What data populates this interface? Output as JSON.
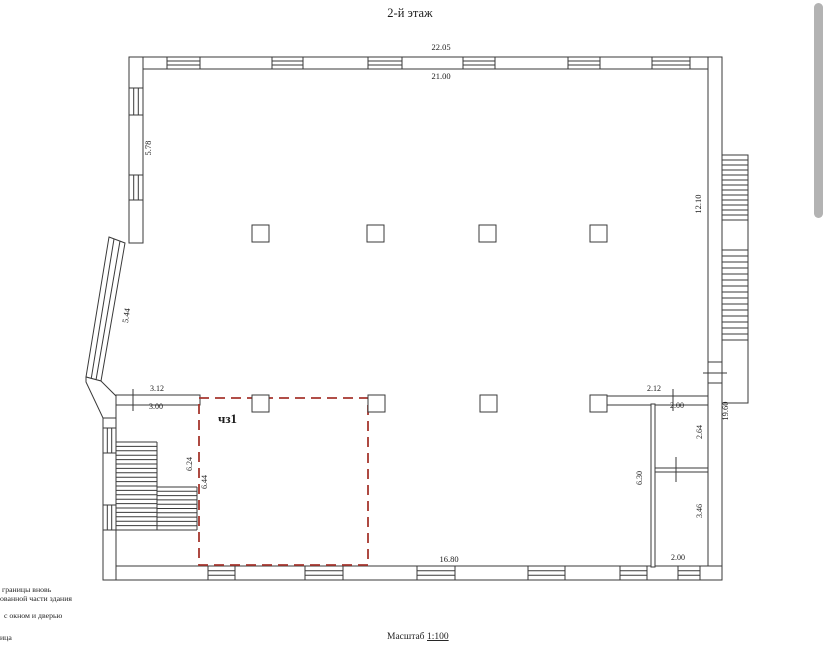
{
  "title": "2-й этаж",
  "room": {
    "label": "чз1"
  },
  "scale": {
    "label": "Масштаб",
    "value": "1:100"
  },
  "legend": {
    "line1": "границы вновь",
    "line2": "ованной части здания",
    "line3": "с окном и дверью",
    "line4": "ица"
  },
  "dimensions": {
    "top_outer": "22.05",
    "top_inner": "21.00",
    "left_upper": "5.78",
    "left_angled": "5.44",
    "right_inner": "12.10",
    "right_stair": "19.60",
    "stair_top_outer": "3.12",
    "stair_top_inner": "3.00",
    "stair_side": "6.24",
    "room_side": "6.44",
    "bottom_inner": "16.80",
    "annex_top_outer": "2.12",
    "annex_top_inner": "2.00",
    "annex_room1_side": "2.64",
    "annex_left": "6.30",
    "annex_room2_side": "3.46",
    "annex_bottom": "2.00"
  },
  "colors": {
    "line": "#3a3a3a",
    "highlight_red": "#a6362e",
    "scrollbar": "#b3b3b3"
  }
}
